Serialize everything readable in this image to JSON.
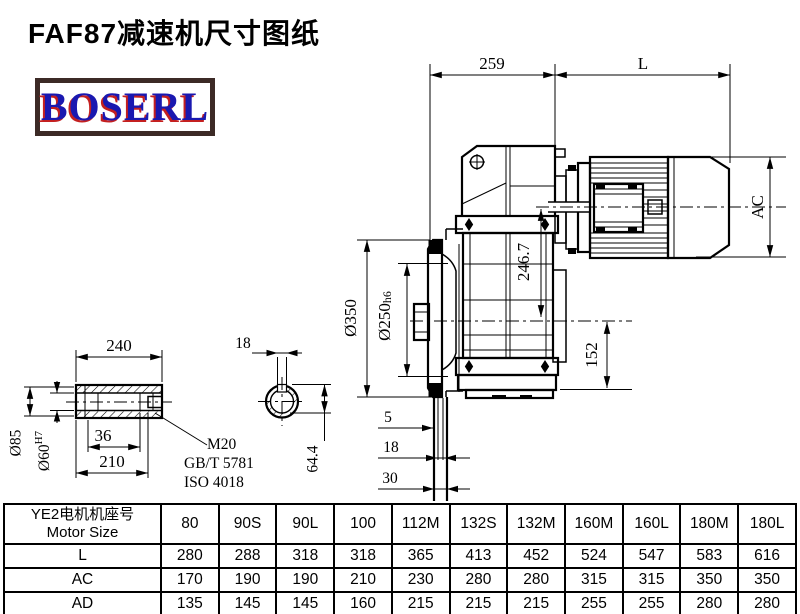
{
  "title": "FAF87减速机尺寸图纸",
  "logo": {
    "text": "BOSERL"
  },
  "colors": {
    "line": "#000000",
    "logo_blue": "#1a18b0",
    "logo_red": "#c42020",
    "logo_border": "#3c2a26"
  },
  "drawing": {
    "top": {
      "d259": "259",
      "dL": "L"
    },
    "motor": {
      "dAC": "AC"
    },
    "housing": {
      "d2467": "246.7",
      "d152": "152"
    },
    "flange": {
      "d350": "Ø350",
      "d250": "Ø250",
      "d250_tol": "h6"
    },
    "shaft_steps": {
      "d5": "5",
      "d18": "18",
      "d30": "30"
    },
    "hollow_shaft": {
      "d240": "240",
      "d85": "Ø85",
      "d60": "Ø60",
      "d60_tol": "H7",
      "d36": "36",
      "d210": "210",
      "thread": "M20",
      "std1": "GB/T 5781",
      "std2": "ISO 4018"
    },
    "bore_section": {
      "d18": "18",
      "d644": "64.4"
    }
  },
  "table": {
    "header_line1": "YE2电机机座号",
    "header_line2": "Motor Size",
    "columns": [
      "80",
      "90S",
      "90L",
      "100",
      "112M",
      "132S",
      "132M",
      "160M",
      "160L",
      "180M",
      "180L"
    ],
    "rows": [
      {
        "label": "L",
        "values": [
          "280",
          "288",
          "318",
          "318",
          "365",
          "413",
          "452",
          "524",
          "547",
          "583",
          "616"
        ]
      },
      {
        "label": "AC",
        "values": [
          "170",
          "190",
          "190",
          "210",
          "230",
          "280",
          "280",
          "315",
          "315",
          "350",
          "350"
        ]
      },
      {
        "label": "AD",
        "values": [
          "135",
          "145",
          "145",
          "160",
          "215",
          "215",
          "215",
          "255",
          "255",
          "280",
          "280"
        ]
      }
    ]
  }
}
